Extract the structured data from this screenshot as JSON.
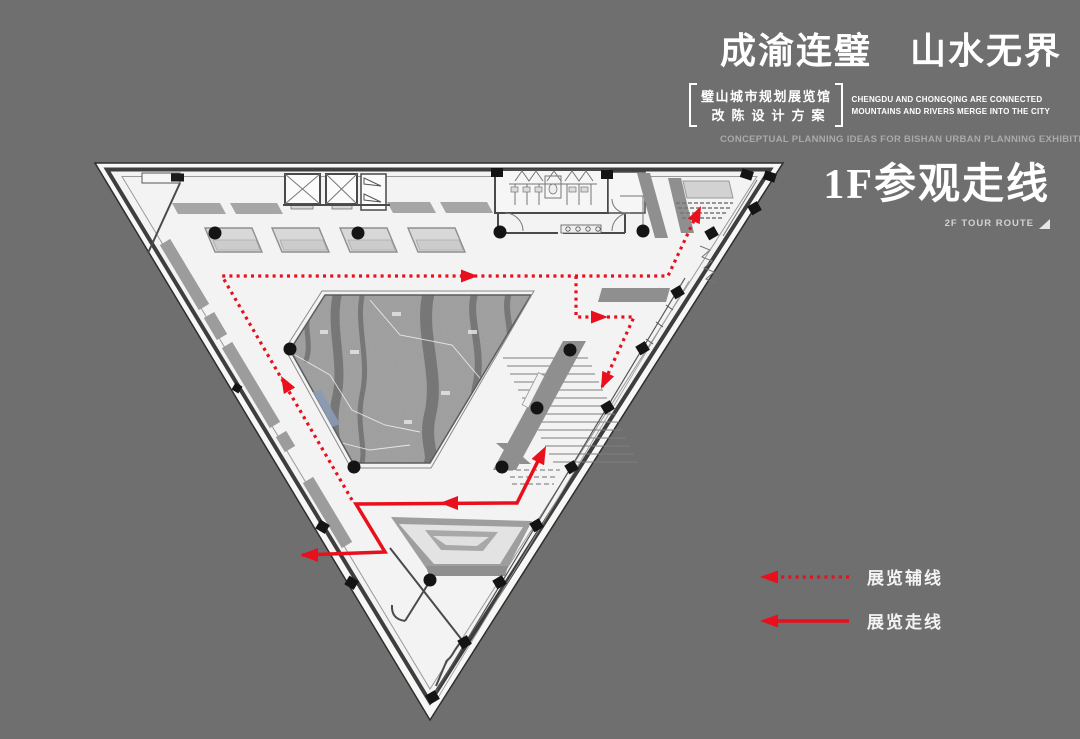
{
  "colors": {
    "background": "#6f6f6f",
    "accent_red": "#e8101c",
    "floor": "#f2f3f2",
    "wall": "#3e3e3e",
    "band_gray": "#9c9c9c",
    "panel_gray": "#a6a6a6",
    "marble_gray": "#a3a3a3",
    "bench_blue": "#8a9ab3",
    "text_white": "#ffffff",
    "text_dim": "#a9aaaa"
  },
  "header": {
    "title": "成渝连璧　山水无界",
    "bracket_line1": "璧山城市规划展览馆",
    "bracket_line2": "改陈设计方案",
    "english_line1": "CHENGDU AND CHONGQING ARE CONNECTED",
    "english_line2": "MOUNTAINS AND RIVERS MERGE INTO THE CITY",
    "subtitle": "CONCEPTUAL PLANNING IDEAS FOR BISHAN URBAN PLANNING EXHIBITION HALL"
  },
  "section": {
    "title": "1F参观走线",
    "subtitle": "2F TOUR ROUTE"
  },
  "legend": {
    "items": [
      {
        "label": "展览辅线",
        "style": "dotted-arrow"
      },
      {
        "label": "展览走线",
        "style": "solid-arrow"
      }
    ]
  },
  "plan": {
    "features": [
      "triangular-floor-plan",
      "elevators",
      "restrooms",
      "exhibit-tables",
      "marble-relief-floor",
      "central-stair-ramp",
      "sunken-forum",
      "escalator",
      "tour-routes",
      "structural-columns"
    ]
  }
}
